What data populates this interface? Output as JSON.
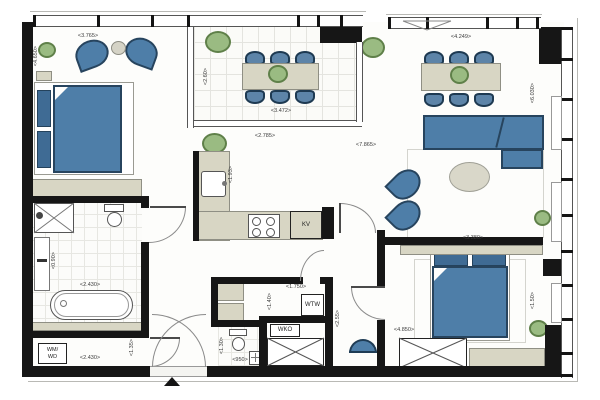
{
  "plan": {
    "type": "apartment-floor-plan",
    "labels": {
      "kv": "KV",
      "wm": "WM/",
      "wd": "WD",
      "wtw": "WTW",
      "wko": "WKO"
    },
    "dims": {
      "bed1_w": "<3.765>",
      "bed1_h": "<4.650>",
      "terrace_w": "<3.472>",
      "terrace_h": "<2.60>",
      "living_w": "<4.249>",
      "living_h": "<6.030>",
      "kitchen_w": "<2.785>",
      "kitchen_d": "<1.93>",
      "main_w": "<7.865>",
      "living_b": "<3.380>",
      "bath_w": "<2.430>",
      "vanity_h": "<0.90>",
      "laundry_w": "<2.430>",
      "laundry_h": "<1.35>",
      "tech_w": "<1.750>",
      "tech_h": "<1.40>",
      "wc_w": "<950>",
      "wc_h": "<1.30>",
      "hall_h": "<2.55>",
      "bed2_w": "<4.850>",
      "bed2_h": "<1.50>"
    },
    "colors": {
      "wall": "#161616",
      "furniture_blue": "#4e7ea8",
      "furniture_blue_dark": "#27445e",
      "cabinet_beige": "#d8d6c4",
      "plant_green": "#9abb82",
      "plant_green_dark": "#5f8049",
      "tile_line": "#e4e4df",
      "dim_text": "#3d3d3d"
    }
  }
}
